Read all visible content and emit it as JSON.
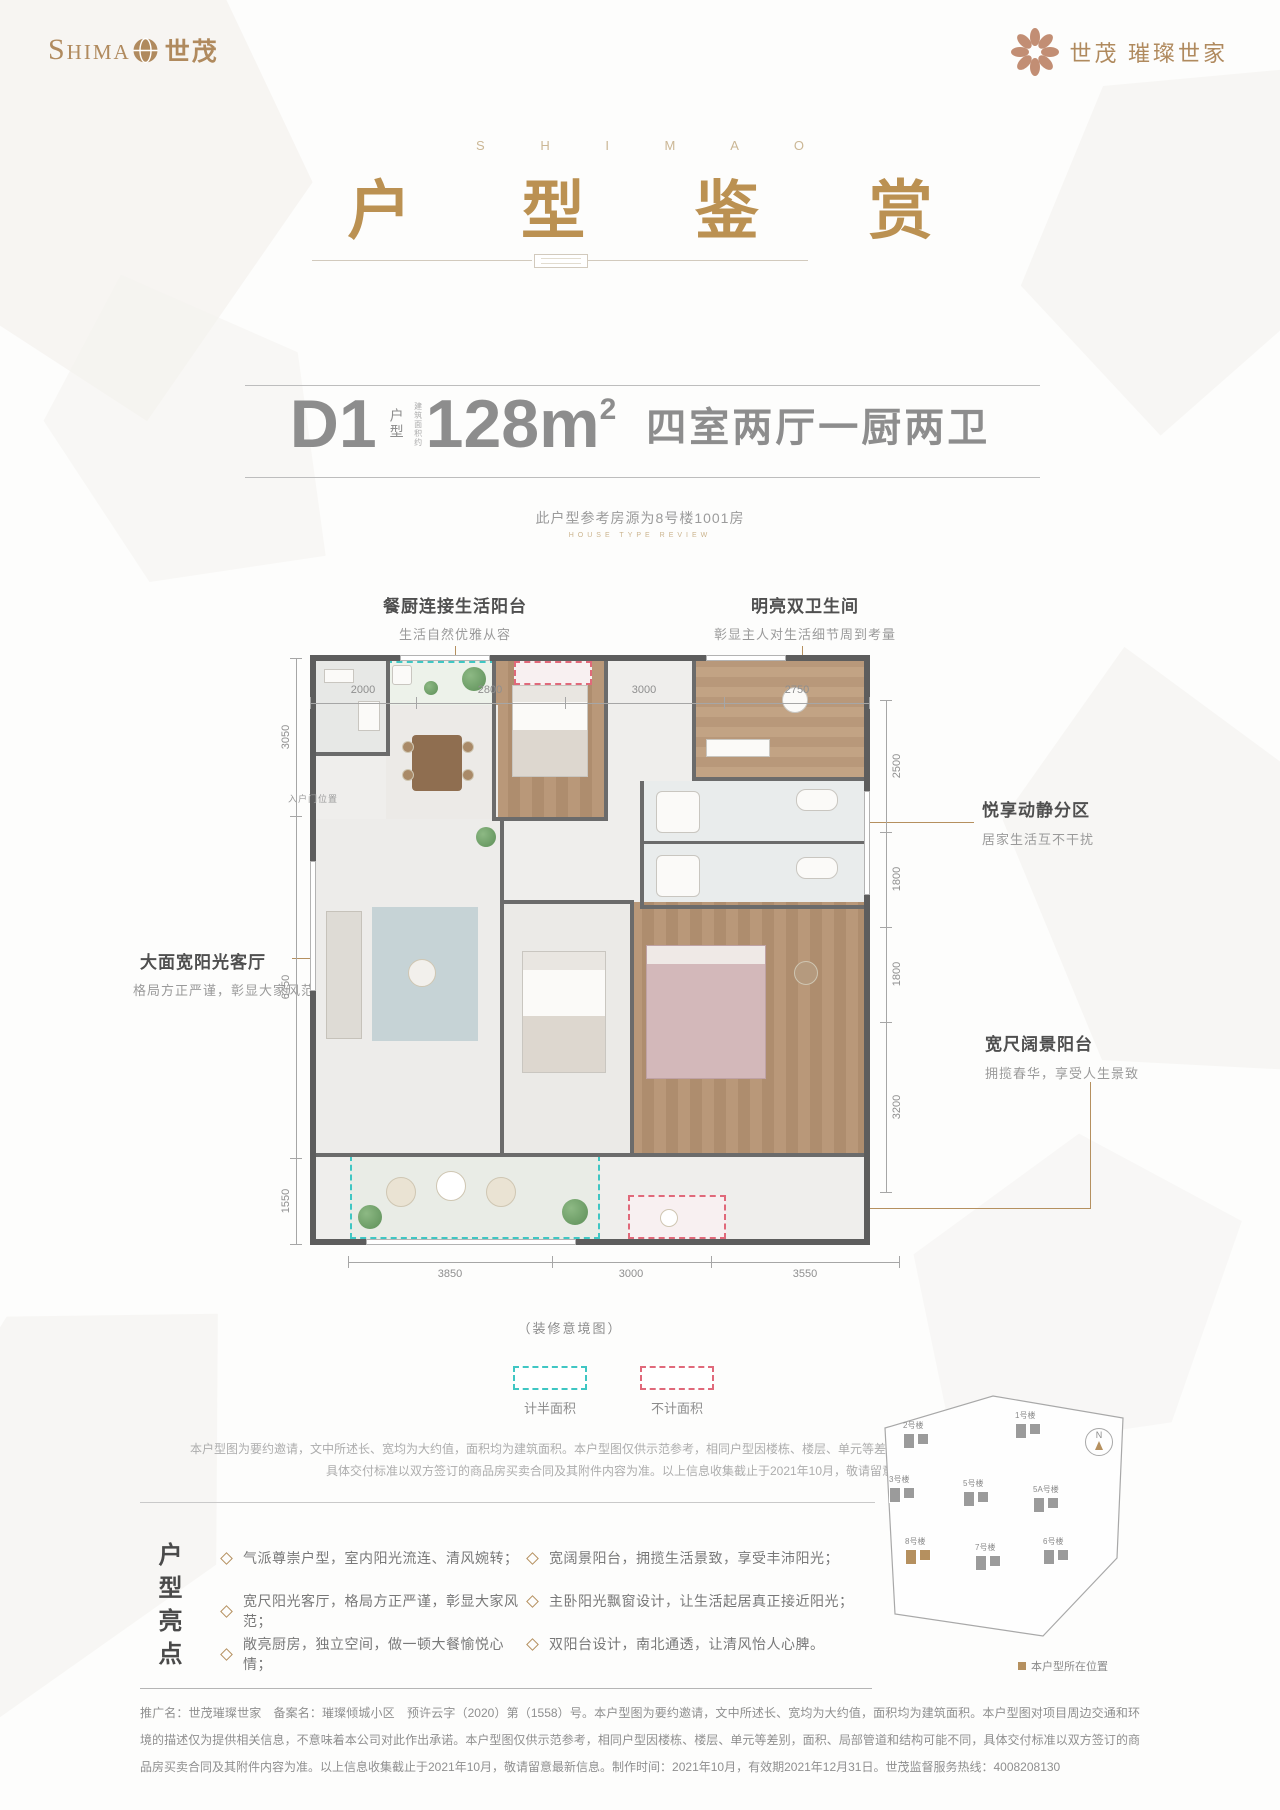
{
  "colors": {
    "brand_gold": "#b08a5e",
    "title_gold": "#bb9152",
    "text_gray": "#8d8d8d",
    "wall_gray": "#5d5d5d",
    "legend_cyan": "#3fc6c3",
    "legend_pink": "#e0697a"
  },
  "header": {
    "logo_left_en": "Shima",
    "logo_left_cn": "世茂",
    "logo_right_cn": "世茂",
    "logo_right_sub": "璀璨世家"
  },
  "title": {
    "en": "S H I M A O",
    "cn": "户 型 鉴 赏"
  },
  "unit": {
    "code": "D1",
    "code_label": "户型",
    "area_label": "建筑面积约",
    "area": "128m",
    "area_sup": "2",
    "rooms": "四室两厅一厨两卫",
    "reference": "此户型参考房源为8号楼1001房",
    "reference_en": "HOUSE TYPE REVIEW"
  },
  "callouts": {
    "kitchen_balcony": {
      "title": "餐厨连接生活阳台",
      "desc": "生活自然优雅从容"
    },
    "bathrooms": {
      "title": "明亮双卫生间",
      "desc": "彰显主人对生活细节周到考量"
    },
    "zoning": {
      "title": "悦享动静分区",
      "desc": "居家生活互不干扰"
    },
    "living_room": {
      "title": "大面宽阳光客厅",
      "desc": "格局方正严谨，彰显大家风范"
    },
    "view_balcony": {
      "title": "宽尺阔景阳台",
      "desc": "拥揽春华，享受人生景致"
    }
  },
  "plan": {
    "entry_label": "入户门位置",
    "caption": "（装修意境图）",
    "dims_top": [
      "2000",
      "2800",
      "3000",
      "2750"
    ],
    "dims_left": [
      "3050",
      "6450",
      "1550"
    ],
    "dims_right": [
      "2500",
      "1800",
      "1800",
      "3200"
    ],
    "dims_bottom": [
      "3850",
      "3000",
      "3550"
    ]
  },
  "legend": {
    "half_area": "计半面积",
    "excluded_area": "不计面积"
  },
  "notes": {
    "line1": "本户型图为要约邀请，文中所述长、宽均为大约值，面积均为建筑面积。本户型图仅供示范参考，相同户型因楼栋、楼层、单元等差别，面积、局部管道和结构可能不同，",
    "line2": "具体交付标准以双方签订的商品房买卖合同及其附件内容为准。以上信息收集截止于2021年10月，敬请留意最新信息。"
  },
  "highlights": {
    "section_title": "户型亮点",
    "items_left": [
      "气派尊崇户型，室内阳光流连、清风婉转；",
      "宽尺阳光客厅，格局方正严谨，彰显大家风范；",
      "敞亮厨房，独立空间，做一顿大餐愉悦心情；"
    ],
    "items_right": [
      "宽阔景阳台，拥揽生活景致，享受丰沛阳光；",
      "主卧阳光飘窗设计，让生活起居真正接近阳光；",
      "双阳台设计，南北通透，让清风怡人心脾。"
    ]
  },
  "sitemap": {
    "compass": "N",
    "buildings": [
      "2号楼",
      "1号楼",
      "3号楼",
      "5号楼",
      "5A号楼",
      "8号楼",
      "7号楼",
      "6号楼"
    ],
    "caption": "本户型所在位置"
  },
  "footer": {
    "text": "推广名：世茂璀璨世家　备案名：璀璨倾城小区　预许云字（2020）第（1558）号。本户型图为要约邀请，文中所述长、宽均为大约值，面积均为建筑面积。本户型图对项目周边交通和环境的描述仅为提供相关信息，不意味着本公司对此作出承诺。本户型图仅供示范参考，相同户型因楼栋、楼层、单元等差别，面积、局部管道和结构可能不同，具体交付标准以双方签订的商品房买卖合同及其附件内容为准。以上信息收集截止于2021年10月，敬请留意最新信息。制作时间：2021年10月，有效期2021年12月31日。世茂监督服务热线：4008208130"
  }
}
